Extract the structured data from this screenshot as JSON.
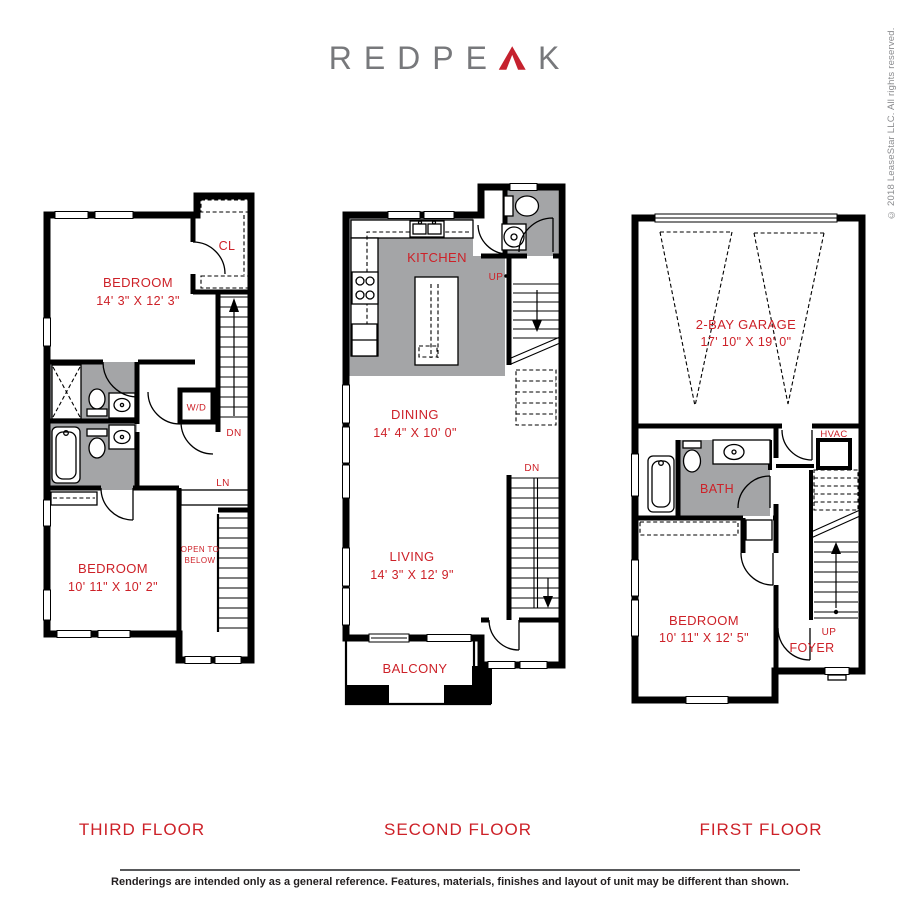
{
  "logo": {
    "text_start": "REDPE",
    "text_end": "K",
    "full_name": "REDPEAK"
  },
  "copyright": "© 2018 LeaseStar LLC. All rights reserved.",
  "colors": {
    "accent_red": "#cd2128",
    "logo_gray": "#77787b",
    "room_shade_gray": "#a4a5a7",
    "wall_black": "#000000"
  },
  "floors": {
    "third": {
      "title": "THIRD FLOOR",
      "bedroom1_name": "BEDROOM",
      "bedroom1_dims": "14' 3\" X 12' 3\"",
      "closet": "CL",
      "washer_dryer": "W/D",
      "down": "DN",
      "linen": "LN",
      "open_line1": "OPEN TO",
      "open_line2": "BELOW",
      "bedroom2_name": "BEDROOM",
      "bedroom2_dims": "10' 11\" X 10' 2\""
    },
    "second": {
      "title": "SECOND FLOOR",
      "kitchen": "KITCHEN",
      "up": "UP",
      "dining_name": "DINING",
      "dining_dims": "14' 4\" X 10' 0\"",
      "down": "DN",
      "living_name": "LIVING",
      "living_dims": "14' 3\" X 12' 9\"",
      "balcony": "BALCONY"
    },
    "first": {
      "title": "FIRST FLOOR",
      "garage_name": "2-BAY GARAGE",
      "garage_dims": "17' 10\" X 19' 0\"",
      "hvac": "HVAC",
      "bath": "BATH",
      "bedroom_name": "BEDROOM",
      "bedroom_dims": "10' 11\" X 12' 5\"",
      "up": "UP",
      "foyer": "FOYER"
    }
  },
  "footer": {
    "disclaimer": "Renderings are intended only as a general reference. Features, materials, finishes and layout of unit may be different than shown."
  }
}
